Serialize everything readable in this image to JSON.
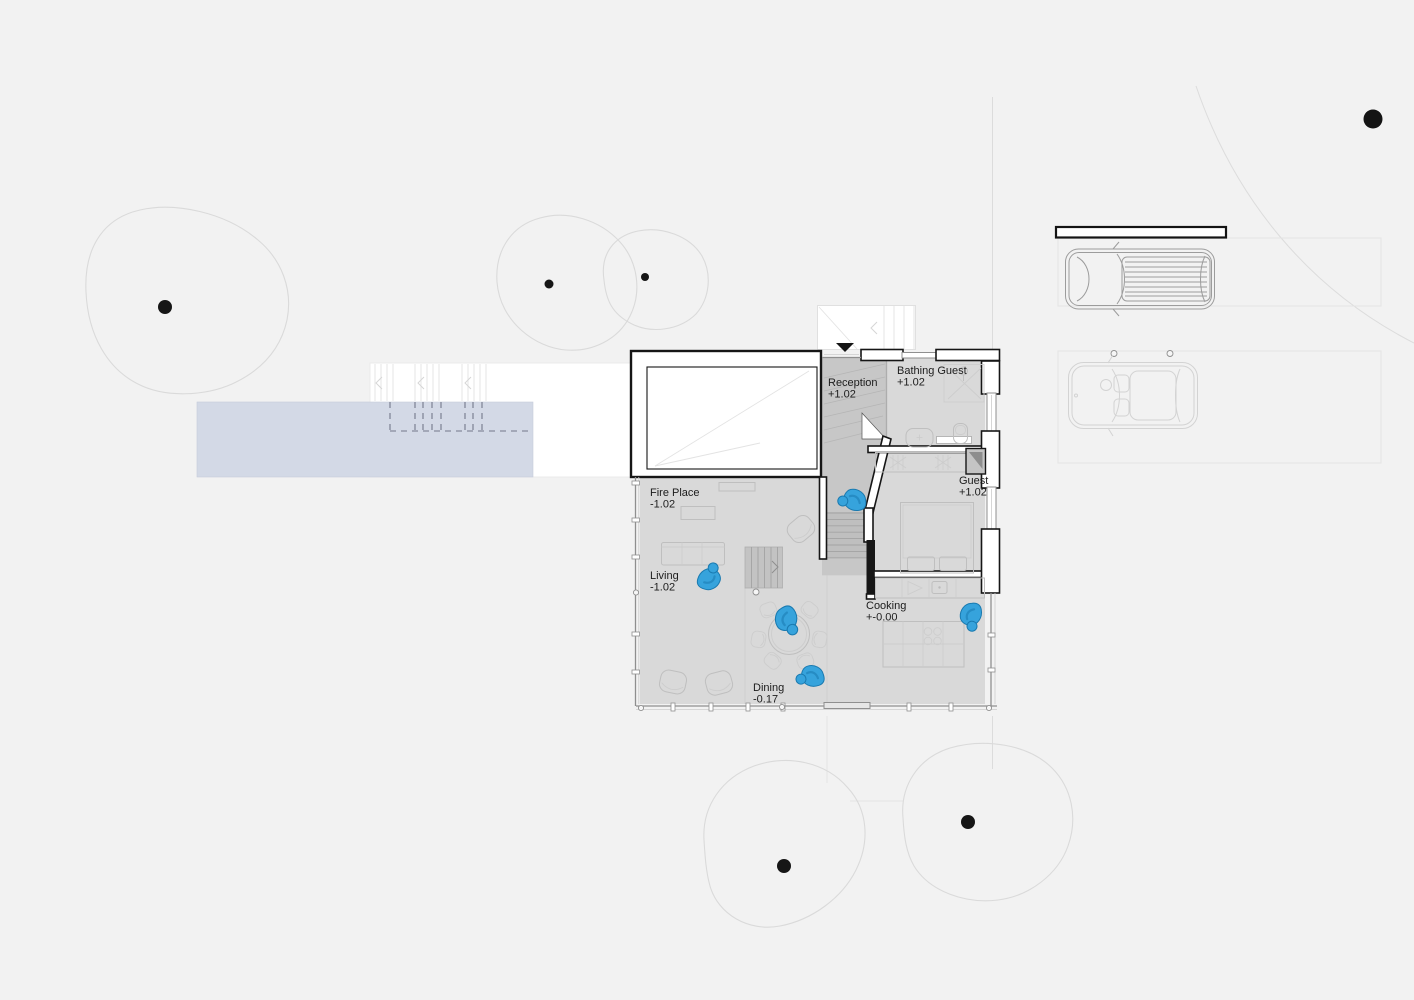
{
  "colors": {
    "background": "#f2f2f2",
    "floor": "#d9d9d9",
    "corridor": "#c7c7c7",
    "stair": "#bfbfbf",
    "wall": "#161616",
    "pool": "#d3d9e6",
    "person": "#36a3dc",
    "person-outline": "#1a7ab0",
    "tree": "#dadada",
    "furniture": "#bfbfbf"
  },
  "rooms": [
    {
      "id": "reception",
      "name": "Reception",
      "level": "+1.02"
    },
    {
      "id": "bathing-guest",
      "name": "Bathing Guest",
      "level": "+1.02"
    },
    {
      "id": "guest",
      "name": "Guest",
      "level": "+1.02"
    },
    {
      "id": "fire-place",
      "name": "Fire Place",
      "level": "-1.02"
    },
    {
      "id": "living",
      "name": "Living",
      "level": "-1.02"
    },
    {
      "id": "cooking",
      "name": "Cooking",
      "level": "+-0.00"
    },
    {
      "id": "dining",
      "name": "Dining",
      "level": "-0.17"
    }
  ],
  "site": {
    "entrance_marker": "down-triangle",
    "tree_count": 5,
    "car_count": 2,
    "figure_count": 5,
    "has_pool": true,
    "has_deck": true
  }
}
